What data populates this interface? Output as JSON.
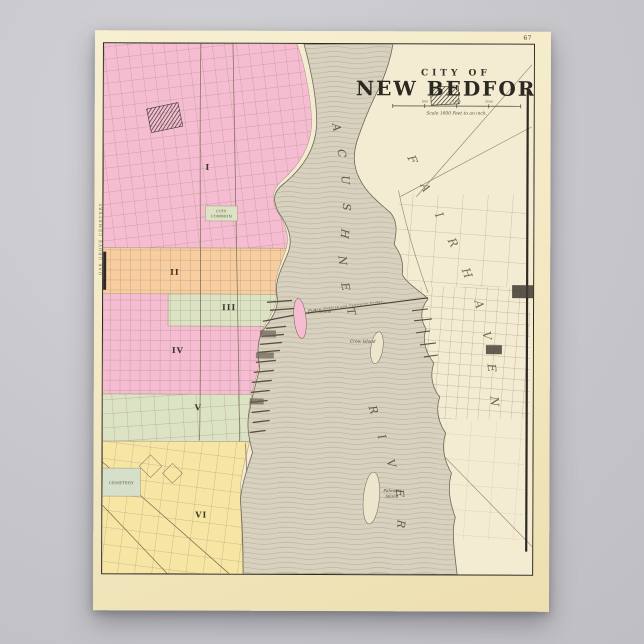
{
  "page_number": "67",
  "title": {
    "kicker": "CITY OF",
    "name": "NEW BEDFORD",
    "scale_note": "Scale 1600 Feet to an inch.",
    "scale_ticks": [
      "800",
      "1600",
      "2400"
    ]
  },
  "river": {
    "name": "ACUSHNET",
    "name_lower": "RIVER"
  },
  "bridge_label": "New Bedford and Fairhaven Bridge",
  "islands": {
    "fish": "Fish Island",
    "crow": "Crow Island",
    "palmers_1": "Palmer's",
    "palmers_2": "Island"
  },
  "east_shore_name": "FAIRHAVEN",
  "wards": {
    "w1": "I",
    "w2": "II",
    "w3": "III",
    "w4": "IV",
    "w5": "V",
    "w6": "VI"
  },
  "landmarks": {
    "city_common_1": "CITY",
    "city_common_2": "COMMON",
    "cemetery": "CEMETERY",
    "oak_grove": "OAK GROVE CEMETERY"
  },
  "colors": {
    "ward_pink": "#f6bdd2",
    "ward_orange": "#f8cda0",
    "ward_green": "#dce3c5",
    "ward_yellow": "#f6e5a3",
    "water": "#d8d1bf",
    "paper": "#f4ecd0",
    "backdrop": "#c7c7cb",
    "ink": "#2e2a23"
  }
}
